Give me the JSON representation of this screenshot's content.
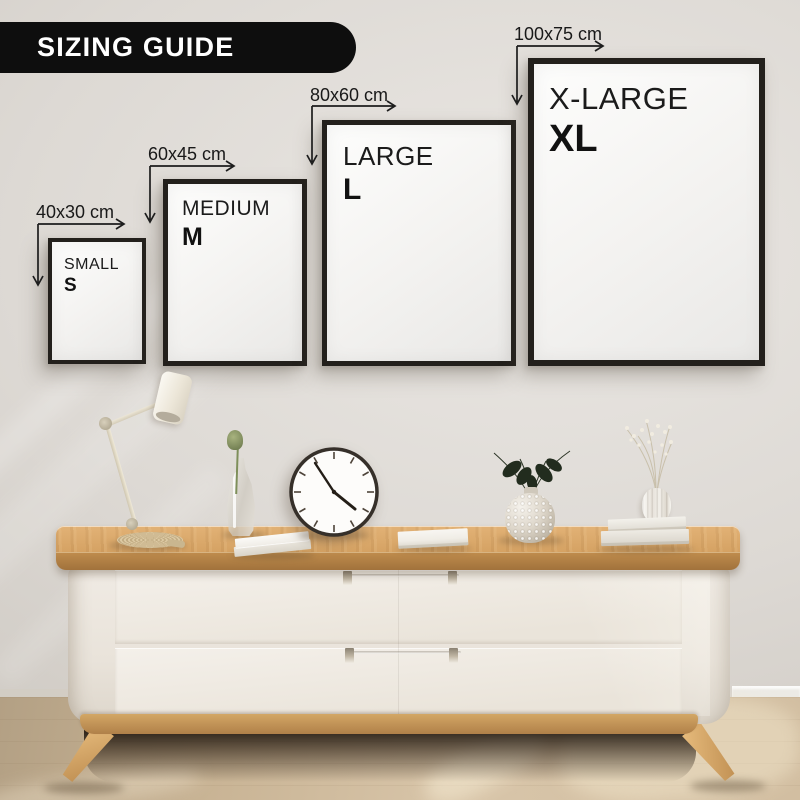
{
  "banner": {
    "title": "SIZING GUIDE"
  },
  "sizes": [
    {
      "label": "SMALL",
      "abbr": "S",
      "dimensions": "40x30 cm"
    },
    {
      "label": "MEDIUM",
      "abbr": "M",
      "dimensions": "60x45 cm"
    },
    {
      "label": "LARGE",
      "abbr": "L",
      "dimensions": "80x60 cm"
    },
    {
      "label": "X-LARGE",
      "abbr": "XL",
      "dimensions": "100x75 cm"
    }
  ],
  "colors": {
    "banner_bg": "#0e0e0e",
    "banner_text": "#ffffff",
    "frame_border": "#23201c",
    "label_text": "#1b1b1b",
    "wall": "#dcd8d3",
    "wood": "#d5a263",
    "floor": "#d2bea1"
  }
}
